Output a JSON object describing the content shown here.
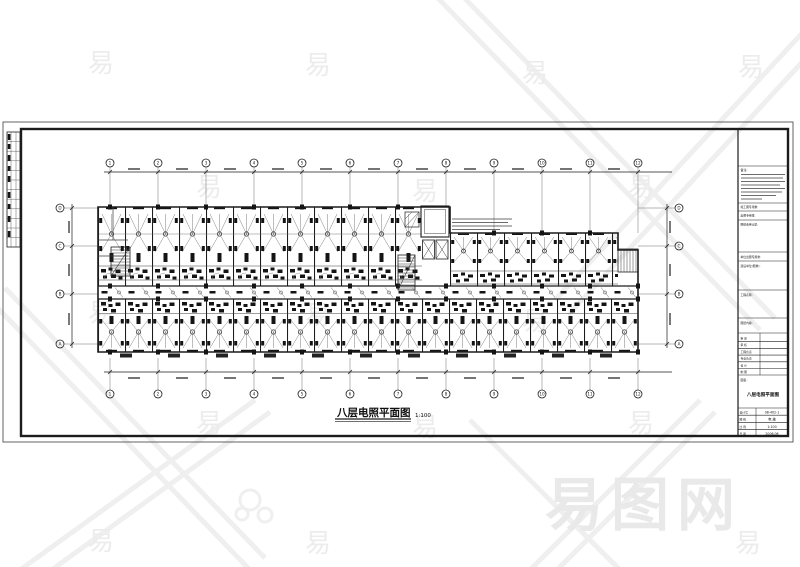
{
  "plan": {
    "title": "八层电照平面图",
    "scale": "1:100"
  },
  "axes": {
    "horizontal": [
      "1",
      "2",
      "3",
      "4",
      "5",
      "6",
      "7",
      "8",
      "9",
      "10",
      "11",
      "12"
    ],
    "vertical": [
      "D",
      "C",
      "B",
      "A"
    ]
  },
  "title_block": {
    "notes_label": "备注:",
    "row1_label": "竣工图专用章:",
    "row2_label": "出图专用章:",
    "review_label": "图纸会审记录:",
    "seal_label": "单位出图专用章:",
    "client_label": "建设单位(图章):",
    "project_label": "工程名称:",
    "sheet_label": "图纸内容:",
    "signature_rows": [
      "审 定",
      "审 核",
      "工程负责",
      "专业负责",
      "设 计",
      "制 图"
    ],
    "name_label": "图名:",
    "drawing_name": "八层电照平面图",
    "info_table": [
      {
        "label": "设计号",
        "value": "08-402-1"
      },
      {
        "label": "图 别",
        "value": "电 施"
      },
      {
        "label": "比 例",
        "value": "1:100"
      },
      {
        "label": "日 期",
        "value": "2006.06"
      }
    ]
  },
  "watermark": {
    "glyph": "易",
    "site_name": "易图网"
  },
  "colors": {
    "line": "#1c1c1c",
    "watermark": "#ececec",
    "paper": "#ffffff"
  }
}
